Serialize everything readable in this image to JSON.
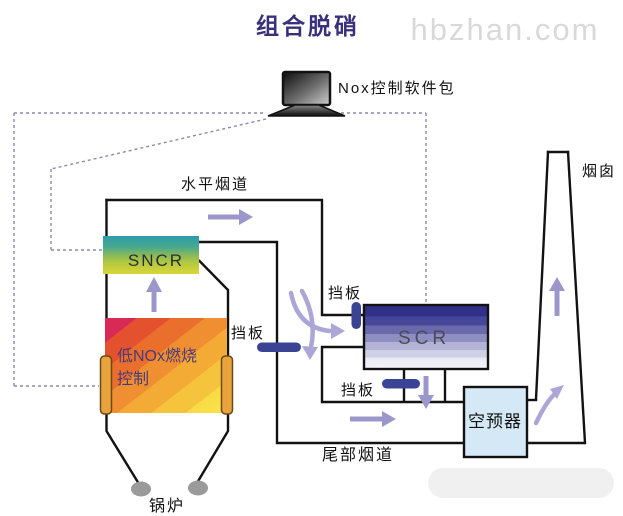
{
  "title": "组合脱硝",
  "watermark": "hbzhan.com",
  "labels": {
    "control_pc": "Nox控制软件包",
    "horizontal_flue": "水平烟道",
    "chimney": "烟囱",
    "tail_flue": "尾部烟道",
    "boiler": "锅炉",
    "damper_scr_inlet": "挡板",
    "damper_boiler_side": "挡板",
    "damper_scr_outlet": "挡板"
  },
  "equipment": {
    "sncr": "SNCR",
    "scr": "SCR",
    "low_nox_line1": "低NOx燃烧",
    "low_nox_line2": "控制",
    "air_preheater": "空预器"
  },
  "colors": {
    "title": "#38307c",
    "watermark": "#d9d9d9",
    "duct_line": "#121212",
    "dashed_control_line": "#8a8aad",
    "arrow": "#9c97ca",
    "damper": "#3b4494",
    "sncr_gradient_top": "#2d9cab",
    "sncr_gradient_bottom": "#d9d739",
    "scr_gradient_top": "#31318a",
    "scr_gradient_bottom": "#f5f6fa",
    "low_nox_gradient_top_left": "#d92a55",
    "low_nox_gradient_bottom_right": "#fbe44c",
    "burner_bar": "#e8a33c",
    "air_preheater_fill": "#d4e9f5",
    "low_nox_text": "#4b3a78"
  }
}
